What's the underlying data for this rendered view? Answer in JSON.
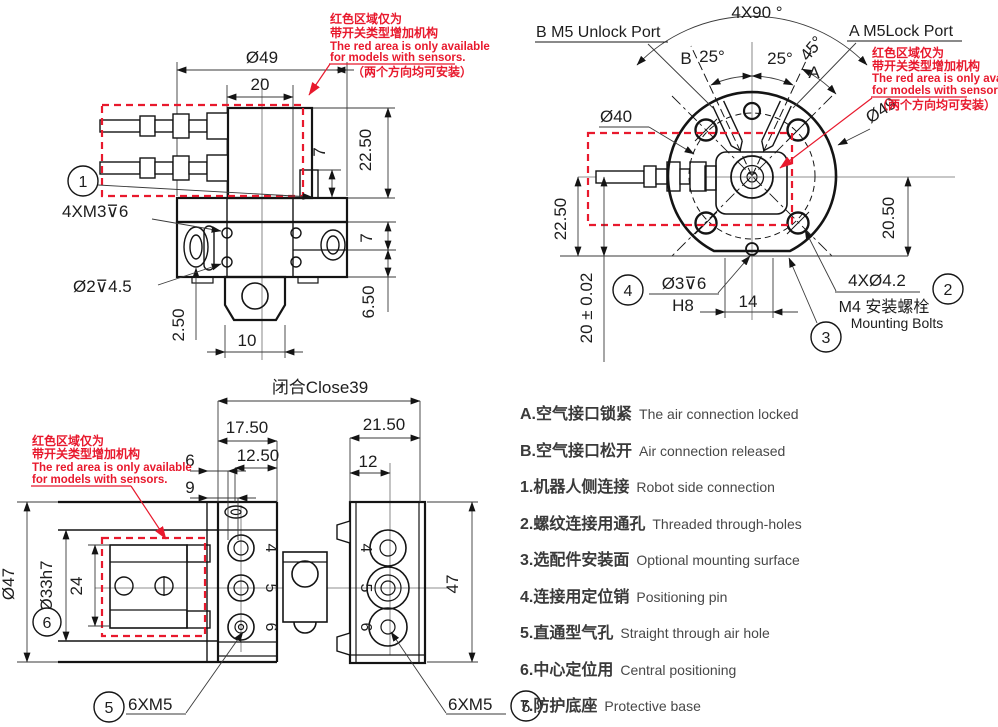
{
  "colors": {
    "red": "#e8192d",
    "line": "#141414"
  },
  "note": {
    "cn1": "红色区域仅为",
    "cn2": "带开关类型增加机构",
    "en1": "The red area is only available",
    "en2": "for models with sensors.",
    "cn3": "（两个方向均可安装）"
  },
  "front": {
    "balloon": "1",
    "dim_d49": "Ø49",
    "dim_20": "20",
    "dim_7a": "7",
    "dim_2250": "22.50",
    "dim_7b": "7",
    "dim_650": "6.50",
    "label_m3": "4XM3⊽6",
    "label_d2": "Ø2⊽4.5",
    "dim_250": "2.50",
    "dim_10": "10"
  },
  "top": {
    "port_b": "B  M5 Unlock  Port",
    "port_a": "A  M5Lock  Port",
    "dim_4x90": "4X90 °",
    "dim_45": "45°",
    "label_b": "B",
    "dim_25l": "25°",
    "dim_25r": "25°",
    "label_a": "A",
    "dim_d40": "Ø40",
    "dim_d49": "Ø49",
    "dim_2250": "22.50",
    "dim_tol": "20 ± 0.02",
    "dim_2050": "20.50",
    "balloon_4": "4",
    "label_pin": "Ø3⊽6",
    "label_h8": "H8",
    "dim_14": "14",
    "label_holes": "4XØ4.2",
    "balloon_2": "2",
    "label_m4_cn": "M4 安装螺栓",
    "label_m4_en": "Mounting Bolts",
    "balloon_3": "3"
  },
  "bottom": {
    "dim_close": "闭合Close39",
    "dim_1750": "17.50",
    "dim_1250": "12.50",
    "dim_6": "6",
    "dim_9": "9",
    "dim_2150": "21.50",
    "dim_12": "12",
    "dim_d47": "Ø47",
    "dim_d33": "Ø33h7",
    "dim_24": "24",
    "balloon_6": "6",
    "dim_47": "47",
    "label_m5_left": "6XM5",
    "label_m5_right": "6XM5",
    "balloon_5_left": "5",
    "balloon_5_right": "5",
    "holes_left": [
      "4",
      "5",
      "6"
    ],
    "holes_right": [
      "4",
      "5",
      "6"
    ]
  },
  "legend": {
    "items": [
      {
        "cn": "A.空气接口锁紧",
        "en": "The air connection locked"
      },
      {
        "cn": "B.空气接口松开",
        "en": "Air connection released"
      },
      {
        "cn": "1.机器人侧连接",
        "en": "Robot side connection"
      },
      {
        "cn": "2.螺纹连接用通孔",
        "en": "Threaded through-holes"
      },
      {
        "cn": "3.选配件安装面",
        "en": "Optional mounting surface"
      },
      {
        "cn": "4.连接用定位销",
        "en": "Positioning pin"
      },
      {
        "cn": "5.直通型气孔",
        "en": "Straight through air hole"
      },
      {
        "cn": "6.中心定位用",
        "en": "Central positioning"
      },
      {
        "cn": "7.防护底座",
        "en": "Protective base"
      }
    ]
  }
}
